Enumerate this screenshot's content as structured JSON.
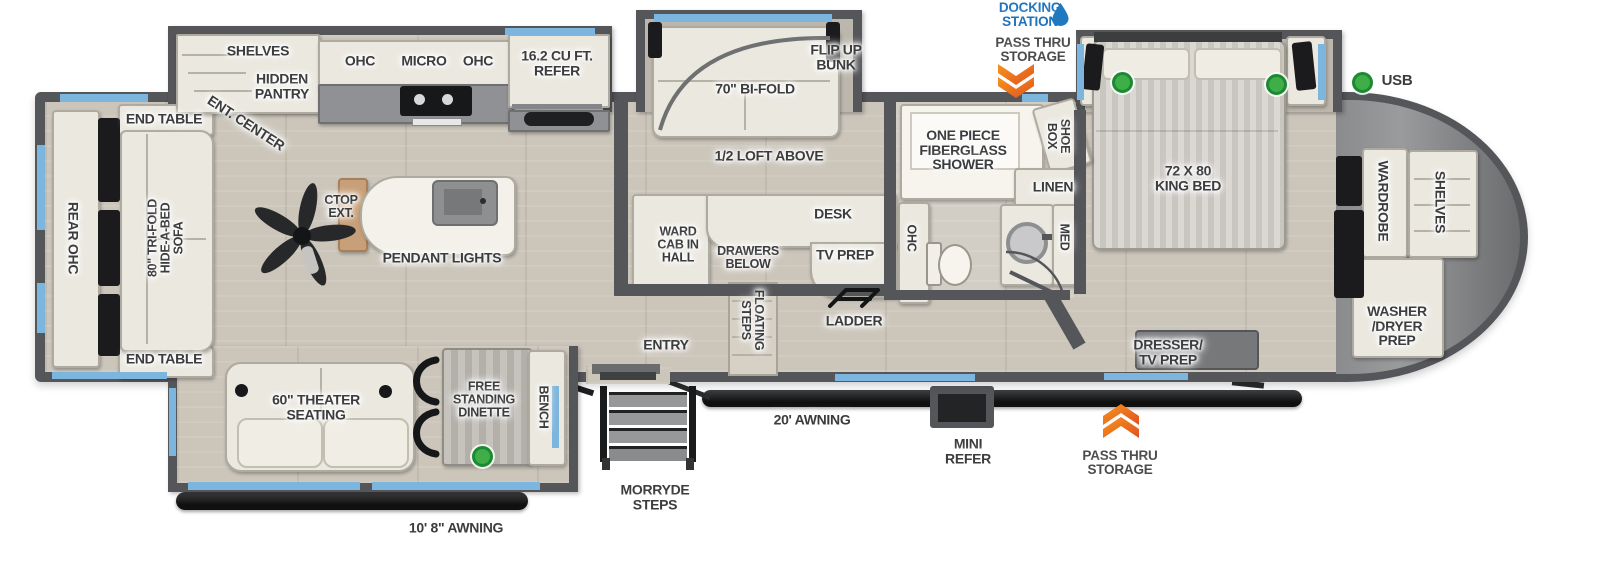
{
  "colors": {
    "wall": "#55565a",
    "window_blue": "#7cb5dd",
    "accent_blue": "#1e73be",
    "accent_orange": "#f26f21",
    "usb_green": "#3fae49",
    "floor": "#cbc5ba"
  },
  "legend_top": {
    "docking_station": "DOCKING\nSTATION",
    "pass_thru": "PASS THRU\nSTORAGE",
    "usb": "USB"
  },
  "exterior": {
    "awning_main": "20' AWNING",
    "awning_rear": "10' 8\" AWNING",
    "morryde": "MORRYDE\nSTEPS",
    "mini_refer": "MINI\nREFER",
    "pass_thru_bottom": "PASS THRU\nSTORAGE",
    "entry": "ENTRY"
  },
  "rear_lounge": {
    "rear_ohc": "REAR OHC",
    "end_table_top": "END TABLE",
    "end_table_bottom": "END TABLE",
    "sofa": "80\" TRI-FOLD\nHIDE-A-BED\nSOFA"
  },
  "kitchen": {
    "shelves": "SHELVES",
    "hidden_pantry": "HIDDEN\nPANTRY",
    "ent_center": "ENT. CENTER",
    "ohc_left": "OHC",
    "micro": "MICRO",
    "ohc_right": "OHC",
    "refer": "16.2 CU FT.\nREFER",
    "ctop_ext": "CTOP\nEXT.",
    "pendant_lights": "PENDANT LIGHTS"
  },
  "bunk_room": {
    "flip_up_bunk": "FLIP UP\nBUNK",
    "bifold": "70\" BI-FOLD",
    "loft": "1/2 LOFT ABOVE",
    "ward_cab": "WARD\nCAB IN\nHALL",
    "drawers_below": "DRAWERS\nBELOW",
    "desk": "DESK",
    "tv_prep": "TV PREP",
    "floating_steps": "FLOATING\nSTEPS",
    "ladder": "LADDER"
  },
  "bathroom": {
    "shower": "ONE PIECE\nFIBERGLASS\nSHOWER",
    "shoe_box": "SHOE\nBOX",
    "linen": "LINEN",
    "ohc": "OHC",
    "med": "MED"
  },
  "bedroom": {
    "king_bed": "72 X 80\nKING BED",
    "dresser_tv": "DRESSER/\nTV PREP",
    "wardrobe": "WARDROBE",
    "shelves": "SHELVES",
    "washer_dryer": "WASHER\n/DRYER\nPREP"
  },
  "living": {
    "theater": "60\" THEATER\nSEATING",
    "dinette": "FREE\nSTANDING\nDINETTE",
    "bench": "BENCH"
  }
}
